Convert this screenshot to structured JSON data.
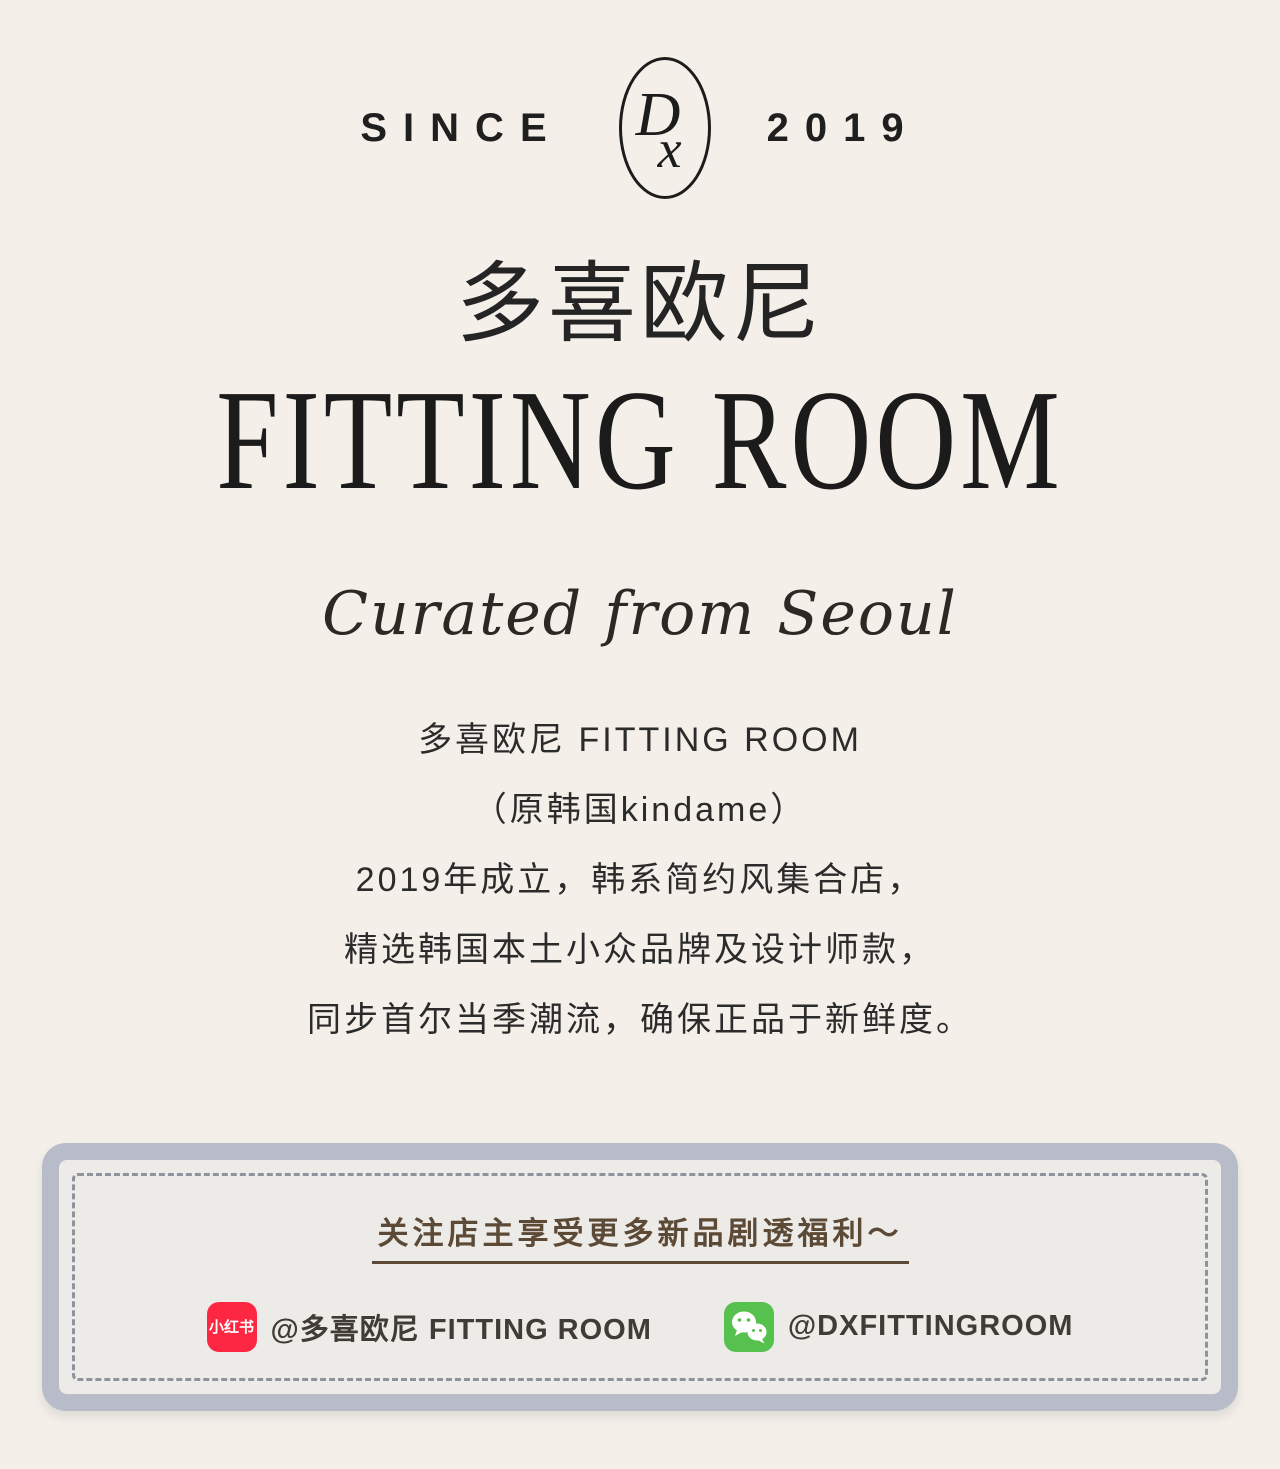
{
  "page": {
    "background_color": "#f4efe9"
  },
  "header": {
    "since_label": "SINCE",
    "year_label": "2019",
    "logo": {
      "letter_d": "D",
      "letter_x": "x"
    }
  },
  "brand": {
    "cn_name": "多喜欧尼",
    "en_name": "FITTING ROOM",
    "tagline": "Curated from Seoul"
  },
  "about": {
    "lines": [
      "多喜欧尼 FITTING ROOM",
      "（原韩国kindame）",
      "2019年成立，韩系简约风集合店，",
      "精选韩国本土小众品牌及设计师款，",
      "同步首尔当季潮流，确保正品于新鲜度。"
    ]
  },
  "follow_box": {
    "heading": "关注店主享受更多新品剧透福利～",
    "accounts": [
      {
        "platform": "xiaohongshu",
        "icon_label": "小红书",
        "icon_color": "#fe2742",
        "handle": "@多喜欧尼 FITTING ROOM"
      },
      {
        "platform": "wechat",
        "icon_color": "#57c14f",
        "handle": "@DXFITTINGROOM"
      }
    ],
    "colors": {
      "outer_border": "#b8bcc9",
      "inner_fill": "#ecebe7",
      "dashed_line": "#8d929d",
      "heading_text": "#5c4936"
    }
  }
}
